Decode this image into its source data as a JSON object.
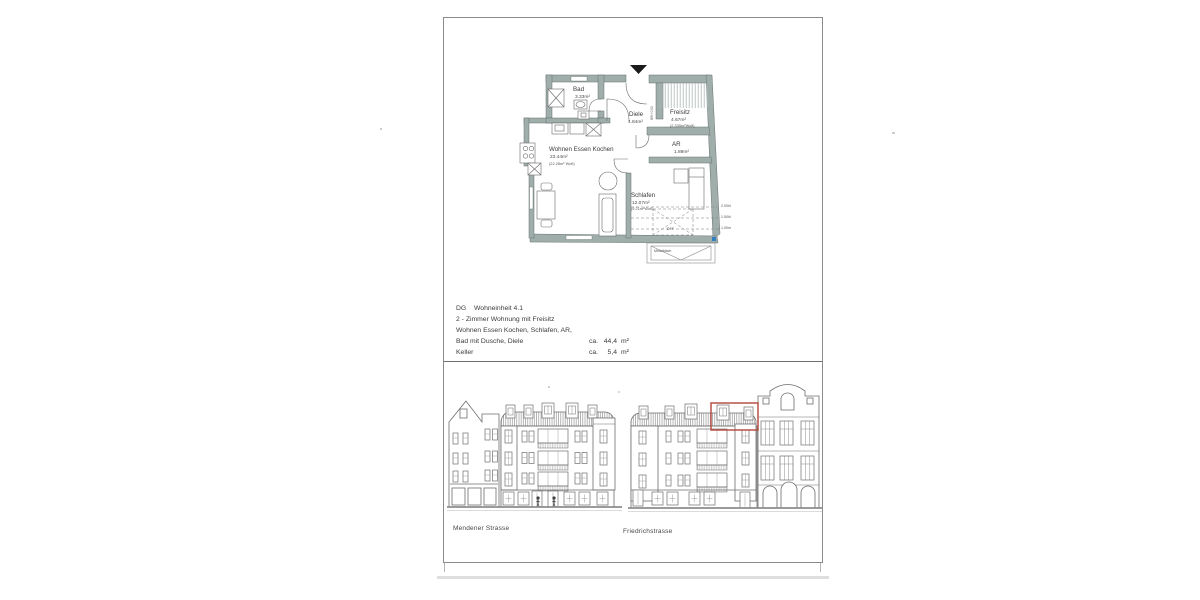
{
  "document": {
    "type_note": "scanned architectural exposé page",
    "info_block": {
      "line1_left": "DG",
      "line1_right": "Wohneinheit 4.1",
      "line2": "2 -  Zimmer Wohnung mit Freisitz",
      "line3": "Wohnen Essen Kochen, Schlafen, AR,",
      "line4_label": "Bad mit Dusche, Diele",
      "line4_ca": "ca.",
      "line4_value": "44,4",
      "line4_unit": "m²",
      "line5_label": "Keller",
      "line5_ca": "ca.",
      "line5_value": "5,4",
      "line5_unit": "m²"
    },
    "floor_plan": {
      "rooms": {
        "bad": {
          "name": "Bad",
          "area": "3.33m²"
        },
        "diele": {
          "name": "Diele",
          "area": "4.84m²"
        },
        "freisitz": {
          "name": "Freisitz",
          "area": "4.67m²",
          "area2": "(2.335m²Wofl)"
        },
        "ar": {
          "name": "AR",
          "area": "1.89m²"
        },
        "wek": {
          "name": "Wohnen Essen Kochen",
          "area": "23.44m²",
          "area2": "(22.28m² Wofl)"
        },
        "schlafen": {
          "name": "Schlafen",
          "area": "12.07m²",
          "area2": "(9.21m²Wofl)"
        }
      },
      "annotations": {
        "brh": "BRH 0.00",
        "dff": "DFF",
        "metalldach": "Metalldach",
        "height_lines": [
          "2.00hl",
          "1.50hl",
          "1.00m"
        ]
      },
      "colors": {
        "wall_fill": "#9FAEAB",
        "highlight_red": "#B5453A",
        "marker_blue": "#2F7FC1"
      }
    },
    "elevations": {
      "left_label": "Mendener Strasse",
      "right_label": "Friedrichstrasse"
    }
  }
}
